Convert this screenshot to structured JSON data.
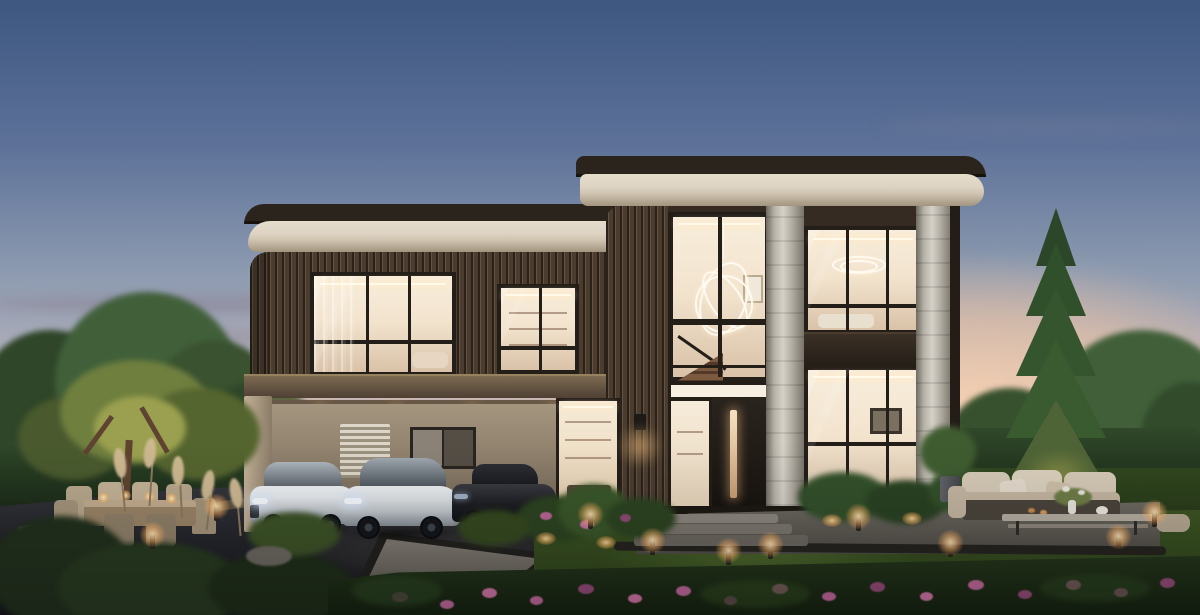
{
  "meta": {
    "description": "Photorealistic dusk exterior rendering of a modern two-storey luxury villa with warm interior lighting, a carport sheltering three cars, and a landscaped evening garden. No text or UI elements appear in the image.",
    "time_of_day": "dusk",
    "objects": [
      "dusk sky with peach sunset glow",
      "modern two-storey luxury villa",
      "rounded flat roofs with cream fascia",
      "bronze vertical-slat cladding",
      "double-height glazed entry with spiral chandelier",
      "round travertine columns",
      "warm-lit interior windows",
      "carport with three cars",
      "white sedan",
      "white liftback",
      "dark sports car",
      "entry door with lit glass strip",
      "stone entry steps",
      "gravel terrace",
      "outdoor lounge sofa with coffee table",
      "outdoor dining table with chairs and candles",
      "uplit garden tree",
      "tall uplit conifer",
      "clipped hedge and topiary",
      "path bollard lights",
      "flower bed with pink blooms",
      "ornamental grasses and pampas plumes",
      "dark paved driveway",
      "lawn"
    ]
  },
  "palette": {
    "sky_top": "#3d5781",
    "sky_mid": "#8c9ab0",
    "sky_lavender": "#c3b4bc",
    "sky_peach": "#ecc9b4",
    "sunset_glow": "#f8d2b2",
    "cloud": "#9b8ea0",
    "roof_dark": "#2b241d",
    "roof_cream": "#ded4c4",
    "roof_cream_shadow": "#a2957f",
    "facade_bronze": "#4a3c2f",
    "facade_dark": "#352b22",
    "frame_dark": "#241e18",
    "glass_bright": "#f8eedd",
    "glass_warm": "#f2e3cd",
    "glass_shadow": "#d9c2a8",
    "stone_light": "#d6d1c8",
    "stone_dark": "#6f6a60",
    "carport_wall": "#a4957f",
    "post_beige": "#c4b299",
    "driveway_top": "#393a40",
    "driveway_bottom": "#16171a",
    "walkway": "#837e74",
    "lawn": "#3c5422",
    "lawn_dark": "#2c421a",
    "lawn_light": "#5a7530",
    "hedge": "#263b21",
    "tree_green": "#41603a",
    "tree_dark": "#2f4628",
    "tree_uplit": "#9aa04f",
    "pine_dark": "#2c462a",
    "pine_light": "#4e6336",
    "gravel": "#6e6a62",
    "gravel_dark": "#504c45",
    "pebble_border": "#26241e",
    "wood_furniture": "#b7a78c",
    "sofa_beige": "#d5c9b6",
    "cushion_light": "#e3dacb",
    "flower_pink": "#bb6695",
    "flower_deep": "#8f4a73",
    "light_core": "#ffe5bd",
    "light_glow": "#f5b060",
    "car_white": "#e8ebee",
    "car_dark": "#1d1e22",
    "window_tint": "#4e555d",
    "trunk_brown": "#5f4330",
    "plume_tan": "#cdb890"
  }
}
